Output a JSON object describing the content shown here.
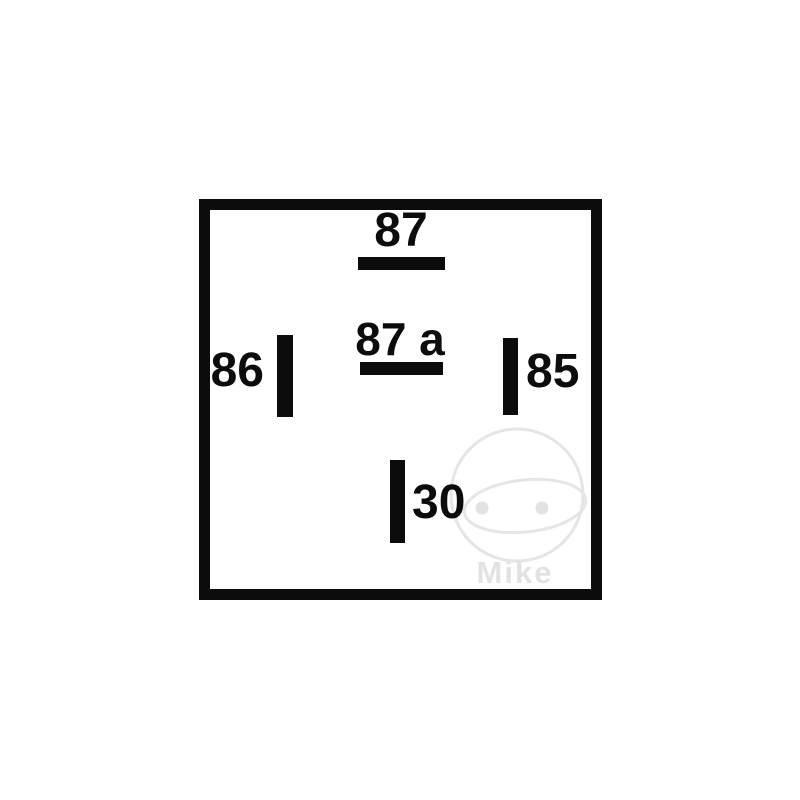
{
  "diagram": {
    "type": "relay-pin-diagram",
    "description": "5-pin automotive relay terminal layout inside square outline",
    "pins": [
      {
        "id": "87",
        "label": "87",
        "blade_orientation": "horizontal",
        "position": "top-center",
        "label_position": "above-blade"
      },
      {
        "id": "87a",
        "label": "87 a",
        "blade_orientation": "horizontal",
        "position": "center",
        "label_position": "above-blade"
      },
      {
        "id": "86",
        "label": "86",
        "blade_orientation": "vertical",
        "position": "middle-left",
        "label_position": "left-of-blade"
      },
      {
        "id": "85",
        "label": "85",
        "blade_orientation": "vertical",
        "position": "middle-right",
        "label_position": "right-of-blade"
      },
      {
        "id": "30",
        "label": "30",
        "blade_orientation": "vertical",
        "position": "bottom-center",
        "label_position": "right-of-blade"
      }
    ],
    "colors": {
      "line": "#0c0c0c",
      "background": "#ffffff",
      "watermark": "#e5e5e5"
    }
  },
  "watermark": {
    "text": "Mike",
    "icon": "helmet-face-with-visor-and-eyes"
  }
}
